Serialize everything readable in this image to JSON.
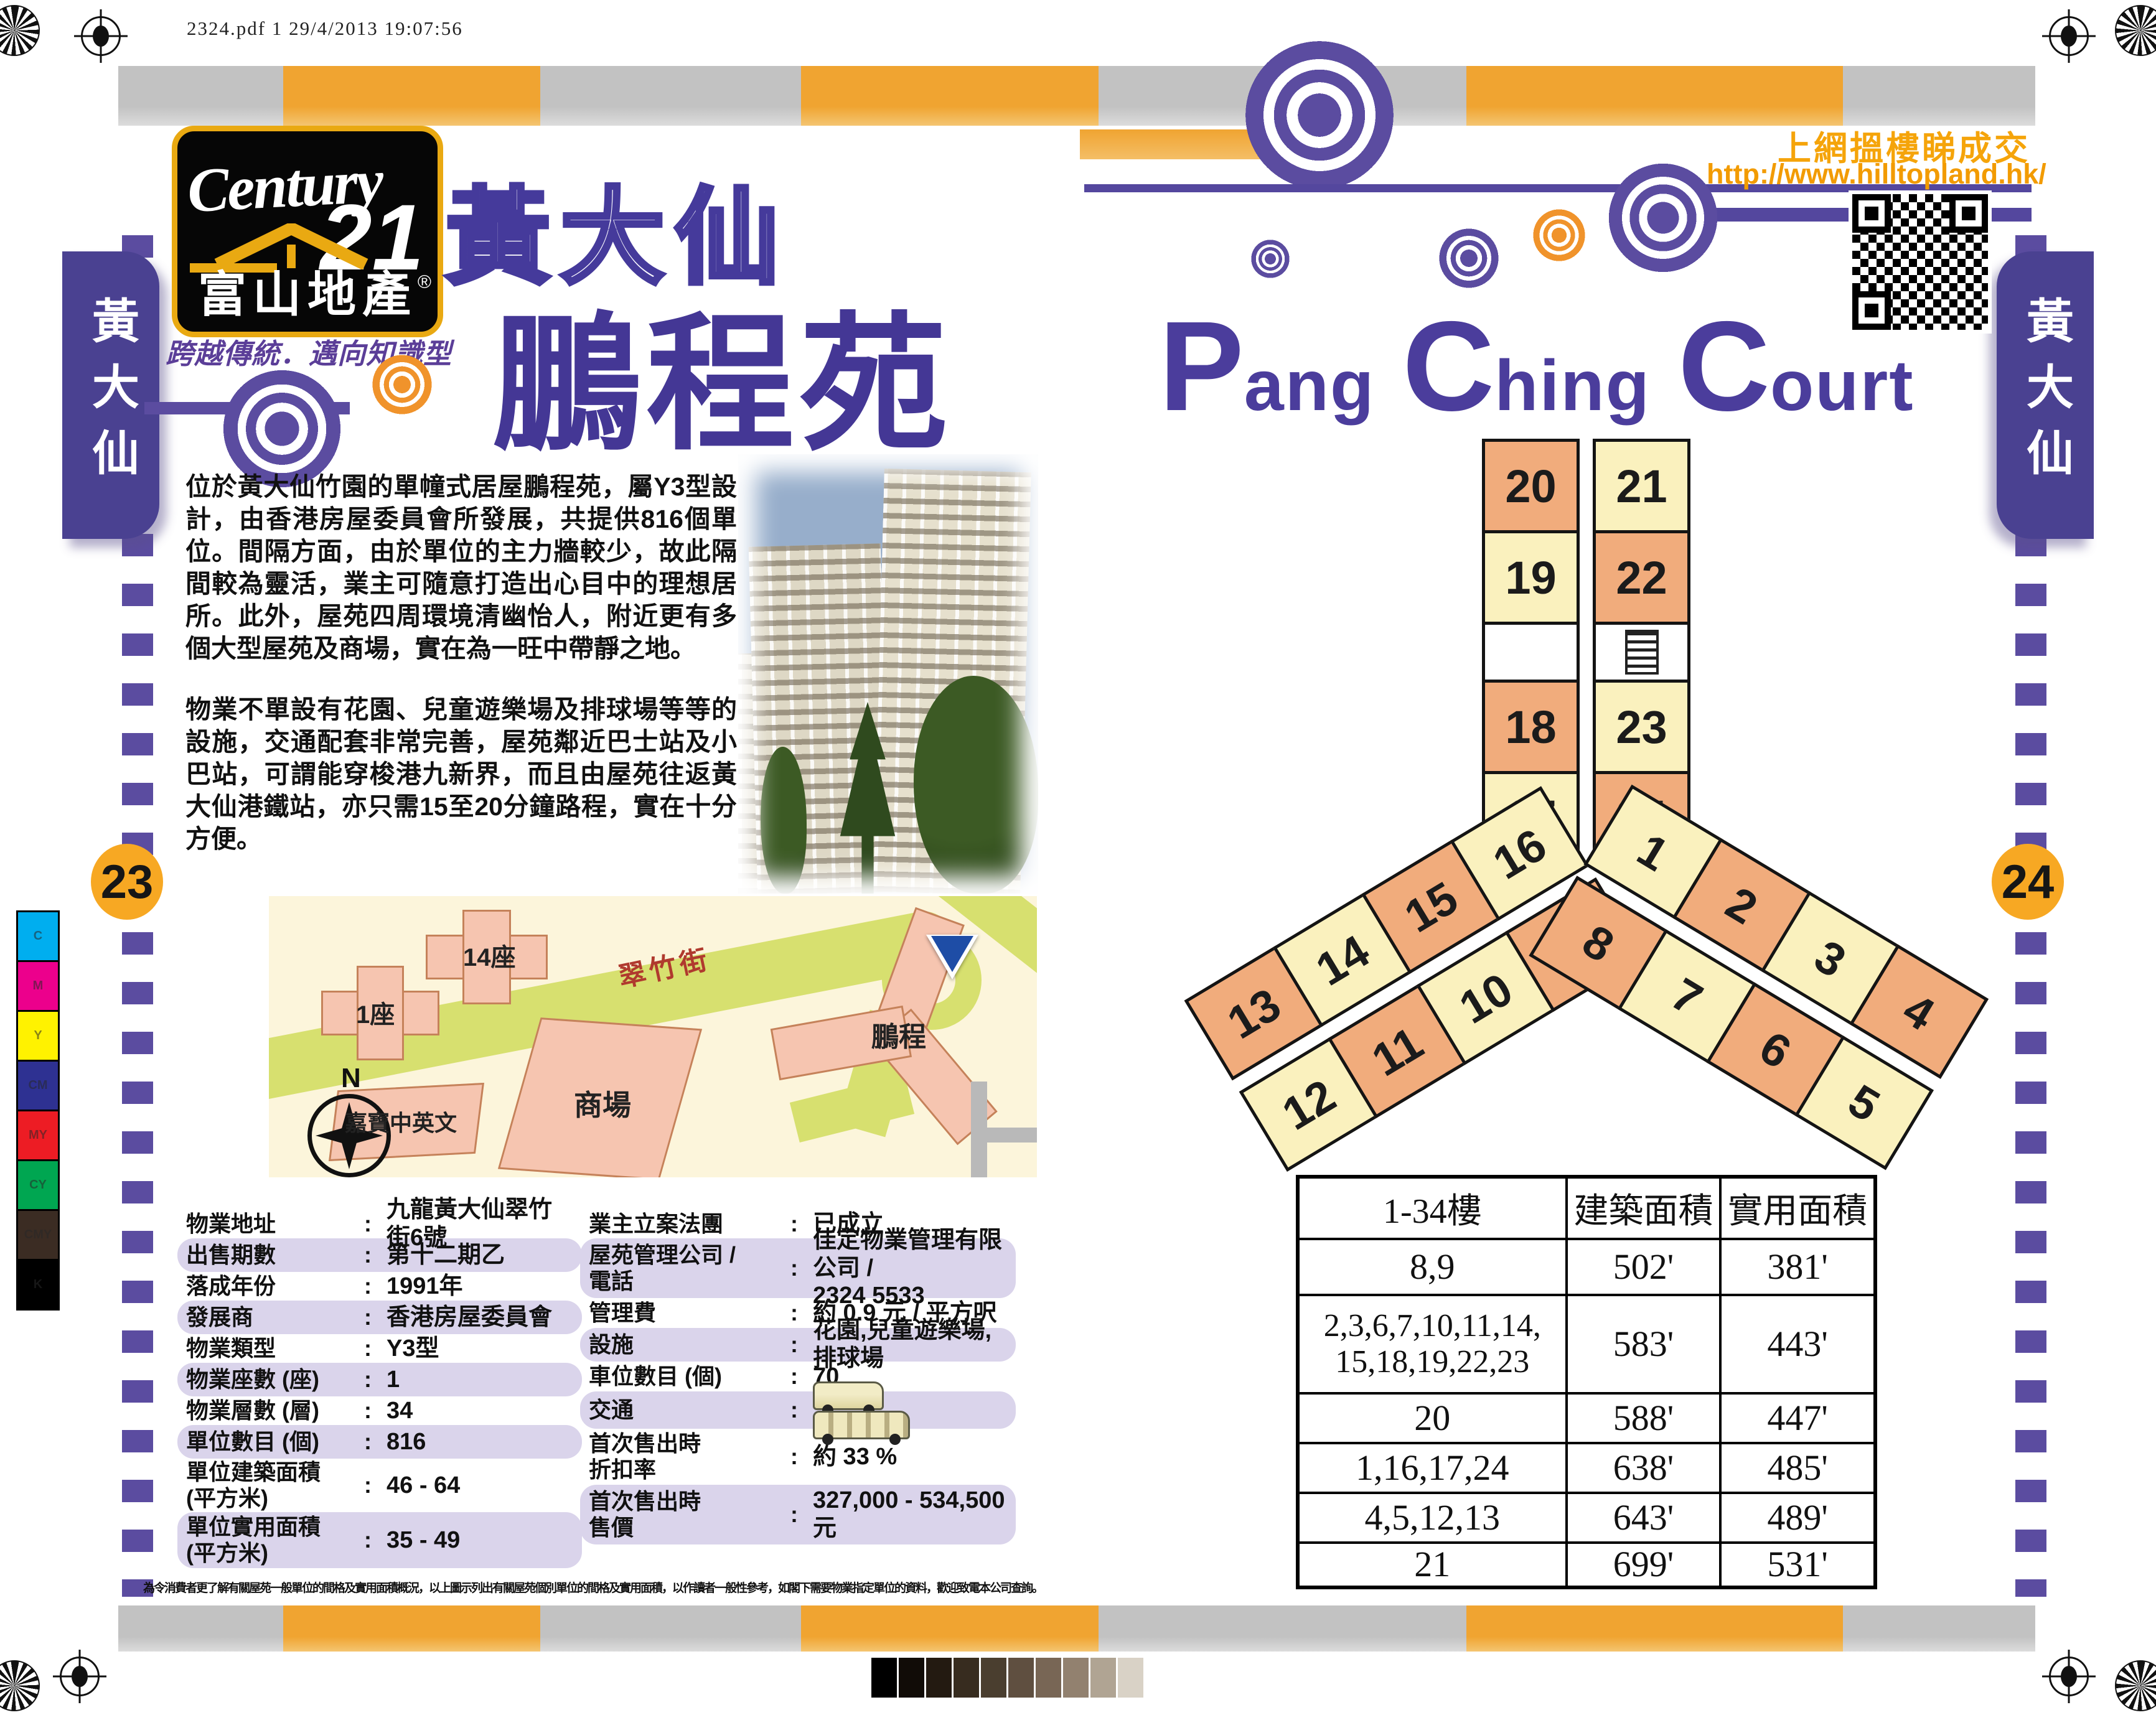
{
  "meta": {
    "print_info": "2324.pdf   1   29/4/2013   19:07:56"
  },
  "brand": {
    "name_script": "Century",
    "name_number": "21",
    "registered": "®",
    "name_cn": "富山地產",
    "tagline": "跨越傳統．邁向知識型"
  },
  "page_left": {
    "side_tab": "黃大仙",
    "page_number": "23",
    "title_district": "黃大仙",
    "title_estate": "鵬程苑",
    "intro_paragraphs": [
      "位於黃大仙竹園的單幢式居屋鵬程苑，屬Y3型設計，由香港房屋委員會所發展，共提供816個單位。間隔方面，由於單位的主力牆較少，故此隔間較為靈活，業主可隨意打造出心目中的理想居所。此外，屋苑四周環境清幽怡人，附近更有多個大型屋苑及商場，實在為一旺中帶靜之地。",
      "物業不單設有花園、兒童遊樂場及排球場等等的設施，交通配套非常完善，屋苑鄰近巴士站及小巴站，可謂能穿梭港九新界，而且由屋苑往返黃大仙港鐵站，亦只需15至20分鐘路程，實在十分方便。"
    ],
    "map": {
      "labels": {
        "block_14": "14座",
        "block_1": "1座",
        "street": "翠竹街",
        "mall": "商場",
        "school": "嘉寶中英文",
        "estate": "鵬程",
        "compass_north": "N"
      }
    },
    "details_left": [
      {
        "label": "物業地址",
        "value": "九龍黃大仙翠竹街6號"
      },
      {
        "label": "出售期數",
        "value": "第十二期乙",
        "hl": true
      },
      {
        "label": "落成年份",
        "value": "1991年"
      },
      {
        "label": "發展商",
        "value": "香港房屋委員會",
        "hl": true
      },
      {
        "label": "物業類型",
        "value": "Y3型"
      },
      {
        "label": "物業座數 (座)",
        "value": "1",
        "hl": true
      },
      {
        "label": "物業層數 (層)",
        "value": "34"
      },
      {
        "label": "單位數目 (個)",
        "value": "816",
        "hl": true
      },
      {
        "label": "單位建築面積",
        "label2": "(平方米)",
        "value": "46 - 64"
      },
      {
        "label": "單位實用面積",
        "label2": "(平方米)",
        "value": "35 - 49",
        "hl": true
      }
    ],
    "details_right": [
      {
        "label": "業主立案法團",
        "value": "已成立"
      },
      {
        "label": "屋苑管理公司 /",
        "label2": "電話",
        "value": "佳定物業管理有限公司 /",
        "value2": "2324 5533",
        "hl": true
      },
      {
        "label": "管理費",
        "value": "約 0.9 元 / 平方呎"
      },
      {
        "label": "設施",
        "value": "花園,兒童遊樂場,排球場",
        "hl": true
      },
      {
        "label": "車位數目 (個)",
        "value": "70"
      },
      {
        "label": "交通",
        "icons": [
          "minibus-icon",
          "double-decker-bus-icon"
        ],
        "hl": true
      },
      {
        "label": "首次售出時",
        "label2": "折扣率",
        "value": "約 33 %"
      },
      {
        "label": "首次售出時",
        "label2": "售價",
        "value": "327,000 - 534,500 元",
        "hl": true
      }
    ],
    "disclaimer": "為令消費者更了解有關屋苑一般單位的間格及實用面積概況，以上圖示列出有關屋苑個別單位的間格及實用面積，以作讀者一般性參考，如閣下需要物業指定單位的資料，歡迎致電本公司查詢。"
  },
  "page_right": {
    "side_tab": "黃大仙",
    "page_number": "24",
    "promo_line": "上網搵樓睇成交",
    "promo_url": "http://www.hilltopland.hk/",
    "title_en_words": [
      {
        "cap": "P",
        "rest": "ang"
      },
      {
        "cap": "C",
        "rest": "hing"
      },
      {
        "cap": "C",
        "rest": "ourt"
      }
    ],
    "floor_plan": {
      "top_arm_rows": [
        [
          {
            "no": "20",
            "tone": "orange"
          },
          {
            "no": "21",
            "tone": "yellow"
          }
        ],
        [
          {
            "no": "19",
            "tone": "yellow"
          },
          {
            "no": "22",
            "tone": "orange"
          }
        ],
        [
          {
            "no": "18",
            "tone": "orange"
          },
          {
            "no": "23",
            "tone": "yellow"
          }
        ],
        [
          {
            "no": "17",
            "tone": "yellow"
          },
          {
            "no": "24",
            "tone": "orange"
          }
        ]
      ],
      "left_arm": {
        "top": [
          {
            "no": "13",
            "tone": "orange"
          },
          {
            "no": "14",
            "tone": "yellow"
          },
          {
            "no": "15",
            "tone": "orange"
          },
          {
            "no": "16",
            "tone": "yellow"
          }
        ],
        "bottom": [
          {
            "no": "12",
            "tone": "yellow"
          },
          {
            "no": "11",
            "tone": "orange"
          },
          {
            "no": "10",
            "tone": "yellow"
          },
          {
            "no": "9",
            "tone": "orange"
          }
        ]
      },
      "right_arm": {
        "top": [
          {
            "no": "1",
            "tone": "yellow"
          },
          {
            "no": "2",
            "tone": "orange"
          },
          {
            "no": "3",
            "tone": "yellow"
          },
          {
            "no": "4",
            "tone": "orange"
          }
        ],
        "bottom": [
          {
            "no": "8",
            "tone": "orange"
          },
          {
            "no": "7",
            "tone": "yellow"
          },
          {
            "no": "6",
            "tone": "orange"
          },
          {
            "no": "5",
            "tone": "yellow"
          }
        ]
      }
    },
    "area_table": {
      "headers": [
        "1-34樓",
        "建築面積",
        "實用面積"
      ],
      "rows": [
        {
          "floors": "8,9",
          "gross": "502'",
          "usable": "381'"
        },
        {
          "floors": "2,3,6,7,10,11,14,\n15,18,19,22,23",
          "gross": "583'",
          "usable": "443'"
        },
        {
          "floors": "20",
          "gross": "588'",
          "usable": "447'"
        },
        {
          "floors": "1,16,17,24",
          "gross": "638'",
          "usable": "485'"
        },
        {
          "floors": "4,5,12,13",
          "gross": "643'",
          "usable": "489'"
        },
        {
          "floors": "21",
          "gross": "699'",
          "usable": "531'"
        }
      ]
    }
  },
  "print_marks": {
    "color_bar": [
      {
        "label": "C",
        "color": "#00AEEF"
      },
      {
        "label": "M",
        "color": "#EC008C"
      },
      {
        "label": "Y",
        "color": "#FFF200"
      },
      {
        "label": "CM",
        "color": "#2E3192"
      },
      {
        "label": "MY",
        "color": "#ED1C24"
      },
      {
        "label": "CY",
        "color": "#00A651"
      },
      {
        "label": "CMY",
        "color": "#3B2C23"
      },
      {
        "label": "K",
        "color": "#000000"
      }
    ],
    "grayscale": [
      "#000000",
      "#110c07",
      "#231a11",
      "#372c1f",
      "#4a3e2f",
      "#5f4f40",
      "#786655",
      "#92816f",
      "#b0a493",
      "#d9d2c6"
    ]
  },
  "colors": {
    "accent_purple": "#4A3C99",
    "deco_purple": "#5B4CA0",
    "accent_orange": "#F0A431",
    "badge_orange": "#F7A823",
    "highlight_row": "#DAD4EB",
    "unit_orange": "#F1AC7C",
    "unit_yellow": "#FAF1BE",
    "map_road_green": "#D7E06F",
    "map_building_pink": "#F6C5B0"
  }
}
